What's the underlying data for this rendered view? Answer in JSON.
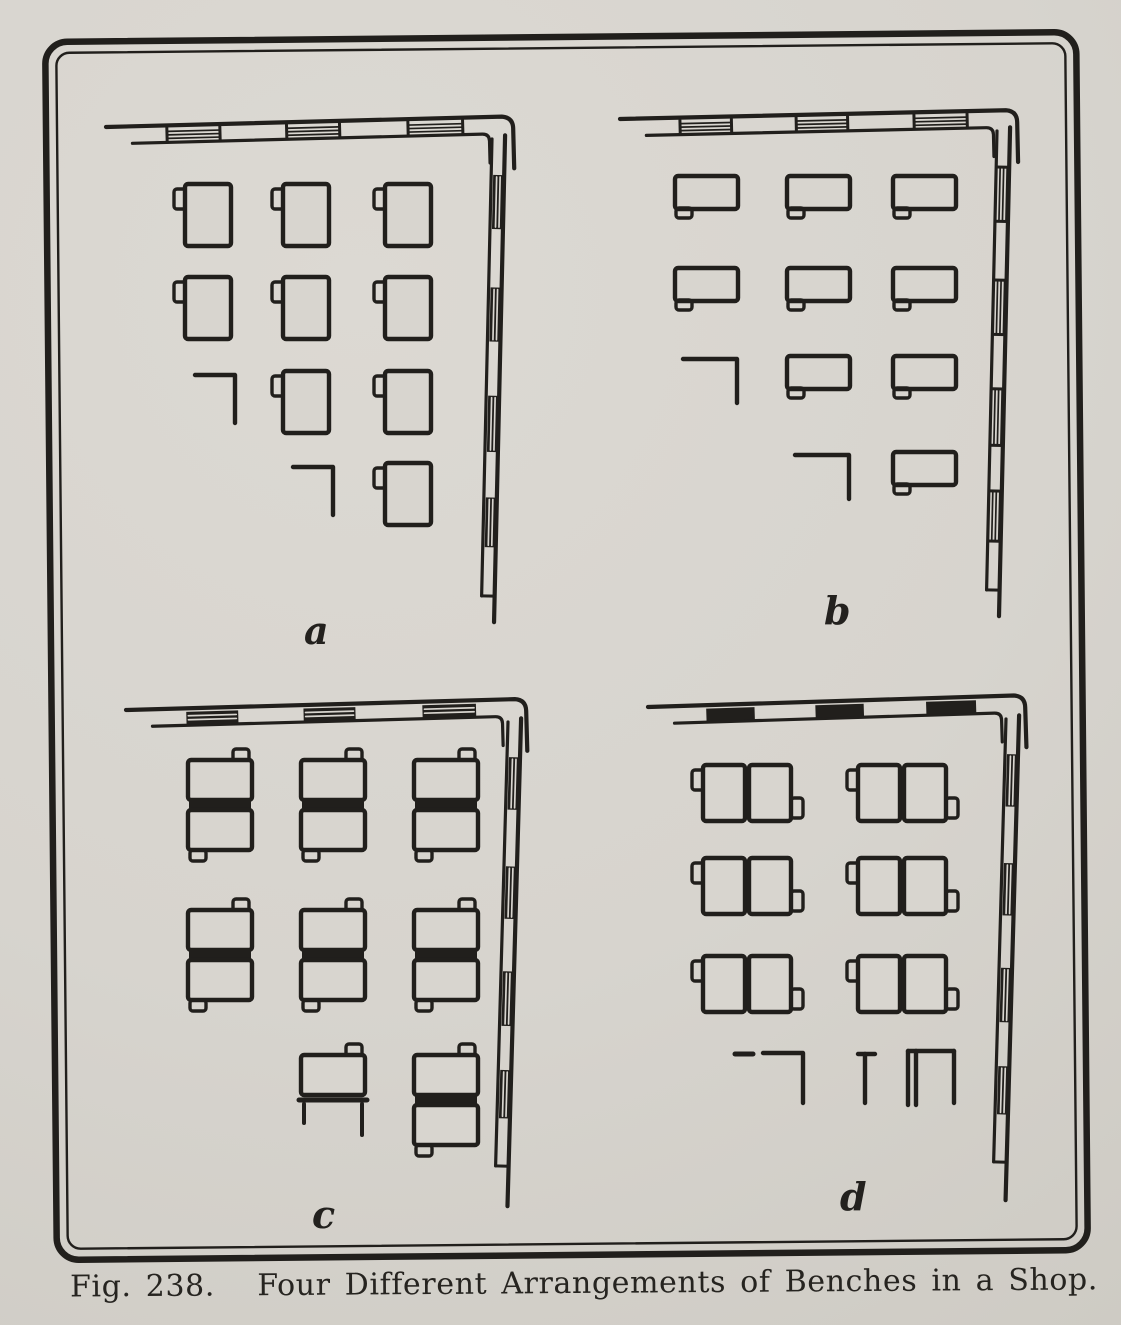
{
  "figure": {
    "caption": "Fig. 238.   Four Different Arrangements of Benches in a Shop.",
    "figure_number": "238",
    "colors": {
      "paper": "#d8d5cf",
      "ink": "#211f1c"
    },
    "plans": [
      {
        "id": "a",
        "label": "a",
        "bench_style": "single-vertical",
        "windows": {
          "top": "hatched",
          "right": "heavy"
        },
        "grid": [
          [
            "bench",
            "bench",
            "bench"
          ],
          [
            "bench",
            "bench",
            "bench"
          ],
          [
            "corner",
            "bench",
            "bench"
          ],
          [
            "empty",
            "corner",
            "bench"
          ]
        ]
      },
      {
        "id": "b",
        "label": "b",
        "bench_style": "single-horizontal",
        "windows": {
          "top": "hatched",
          "right": "hatched"
        },
        "grid": [
          [
            "bench",
            "bench",
            "bench"
          ],
          [
            "bench",
            "bench",
            "bench"
          ],
          [
            "corner",
            "bench",
            "bench"
          ],
          [
            "empty",
            "corner",
            "bench"
          ]
        ]
      },
      {
        "id": "c",
        "label": "c",
        "bench_style": "double-back-to-back",
        "windows": {
          "top": "heavy",
          "right": "heavy"
        },
        "grid": [
          [
            "unit",
            "unit",
            "unit"
          ],
          [
            "unit",
            "unit",
            "unit"
          ],
          [
            "empty",
            "partial",
            "unit"
          ]
        ]
      },
      {
        "id": "d",
        "label": "d",
        "bench_style": "pair-side-by-side",
        "windows": {
          "top": "dark",
          "right": "heavy"
        },
        "grid": [
          [
            "unit",
            "unit"
          ],
          [
            "unit",
            "unit"
          ],
          [
            "unit",
            "unit"
          ],
          [
            "partial-left",
            "partial-right"
          ]
        ]
      }
    ]
  }
}
